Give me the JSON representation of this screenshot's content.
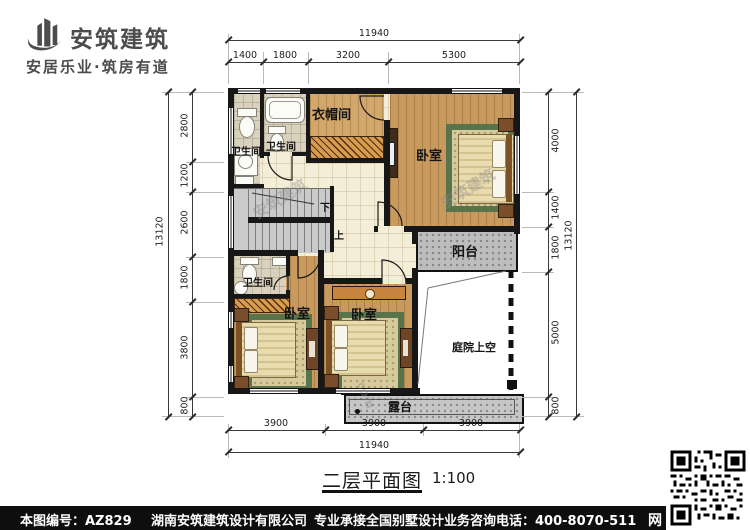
{
  "header": {
    "brand": "安筑建筑",
    "tagline": "安居乐业·筑房有道"
  },
  "plan": {
    "rooms": {
      "bath1": "卫生间",
      "bath2": "卫生间",
      "bath3": "卫生间",
      "cloak": "衣帽间",
      "bedroom_top": "卧室",
      "bedroom_bottom_left": "卧室",
      "bedroom_bottom_mid": "卧室",
      "balcony": "阳台",
      "void": "庭院上空",
      "terrace": "露台",
      "stair_down": "下",
      "stair_up": "上"
    },
    "watermark": {
      "brand": "安筑建筑",
      "suffix": "com"
    }
  },
  "dims": {
    "top": {
      "total": "11940",
      "segments": [
        "1400",
        "1800",
        "3200",
        "5300"
      ]
    },
    "bottom": {
      "total": "11940",
      "segments": [
        "3900",
        "3900",
        "3900"
      ]
    },
    "left": {
      "total": "13120",
      "segments": [
        "2800",
        "1200",
        "2600",
        "1800",
        "3800",
        "800"
      ]
    },
    "right": {
      "total": "13120",
      "segments": [
        "4000",
        "1400",
        "1800",
        "5000",
        "800"
      ]
    }
  },
  "title": {
    "text": "二层平面图",
    "scale": "1:100"
  },
  "footer": {
    "plan_no": "本图编号：AZ829",
    "company": "湖南安筑建筑设计有限公司",
    "service": "专业承接全国别墅设计业务",
    "phone": "咨询电话：400-8070-511",
    "web_char": "网"
  }
}
